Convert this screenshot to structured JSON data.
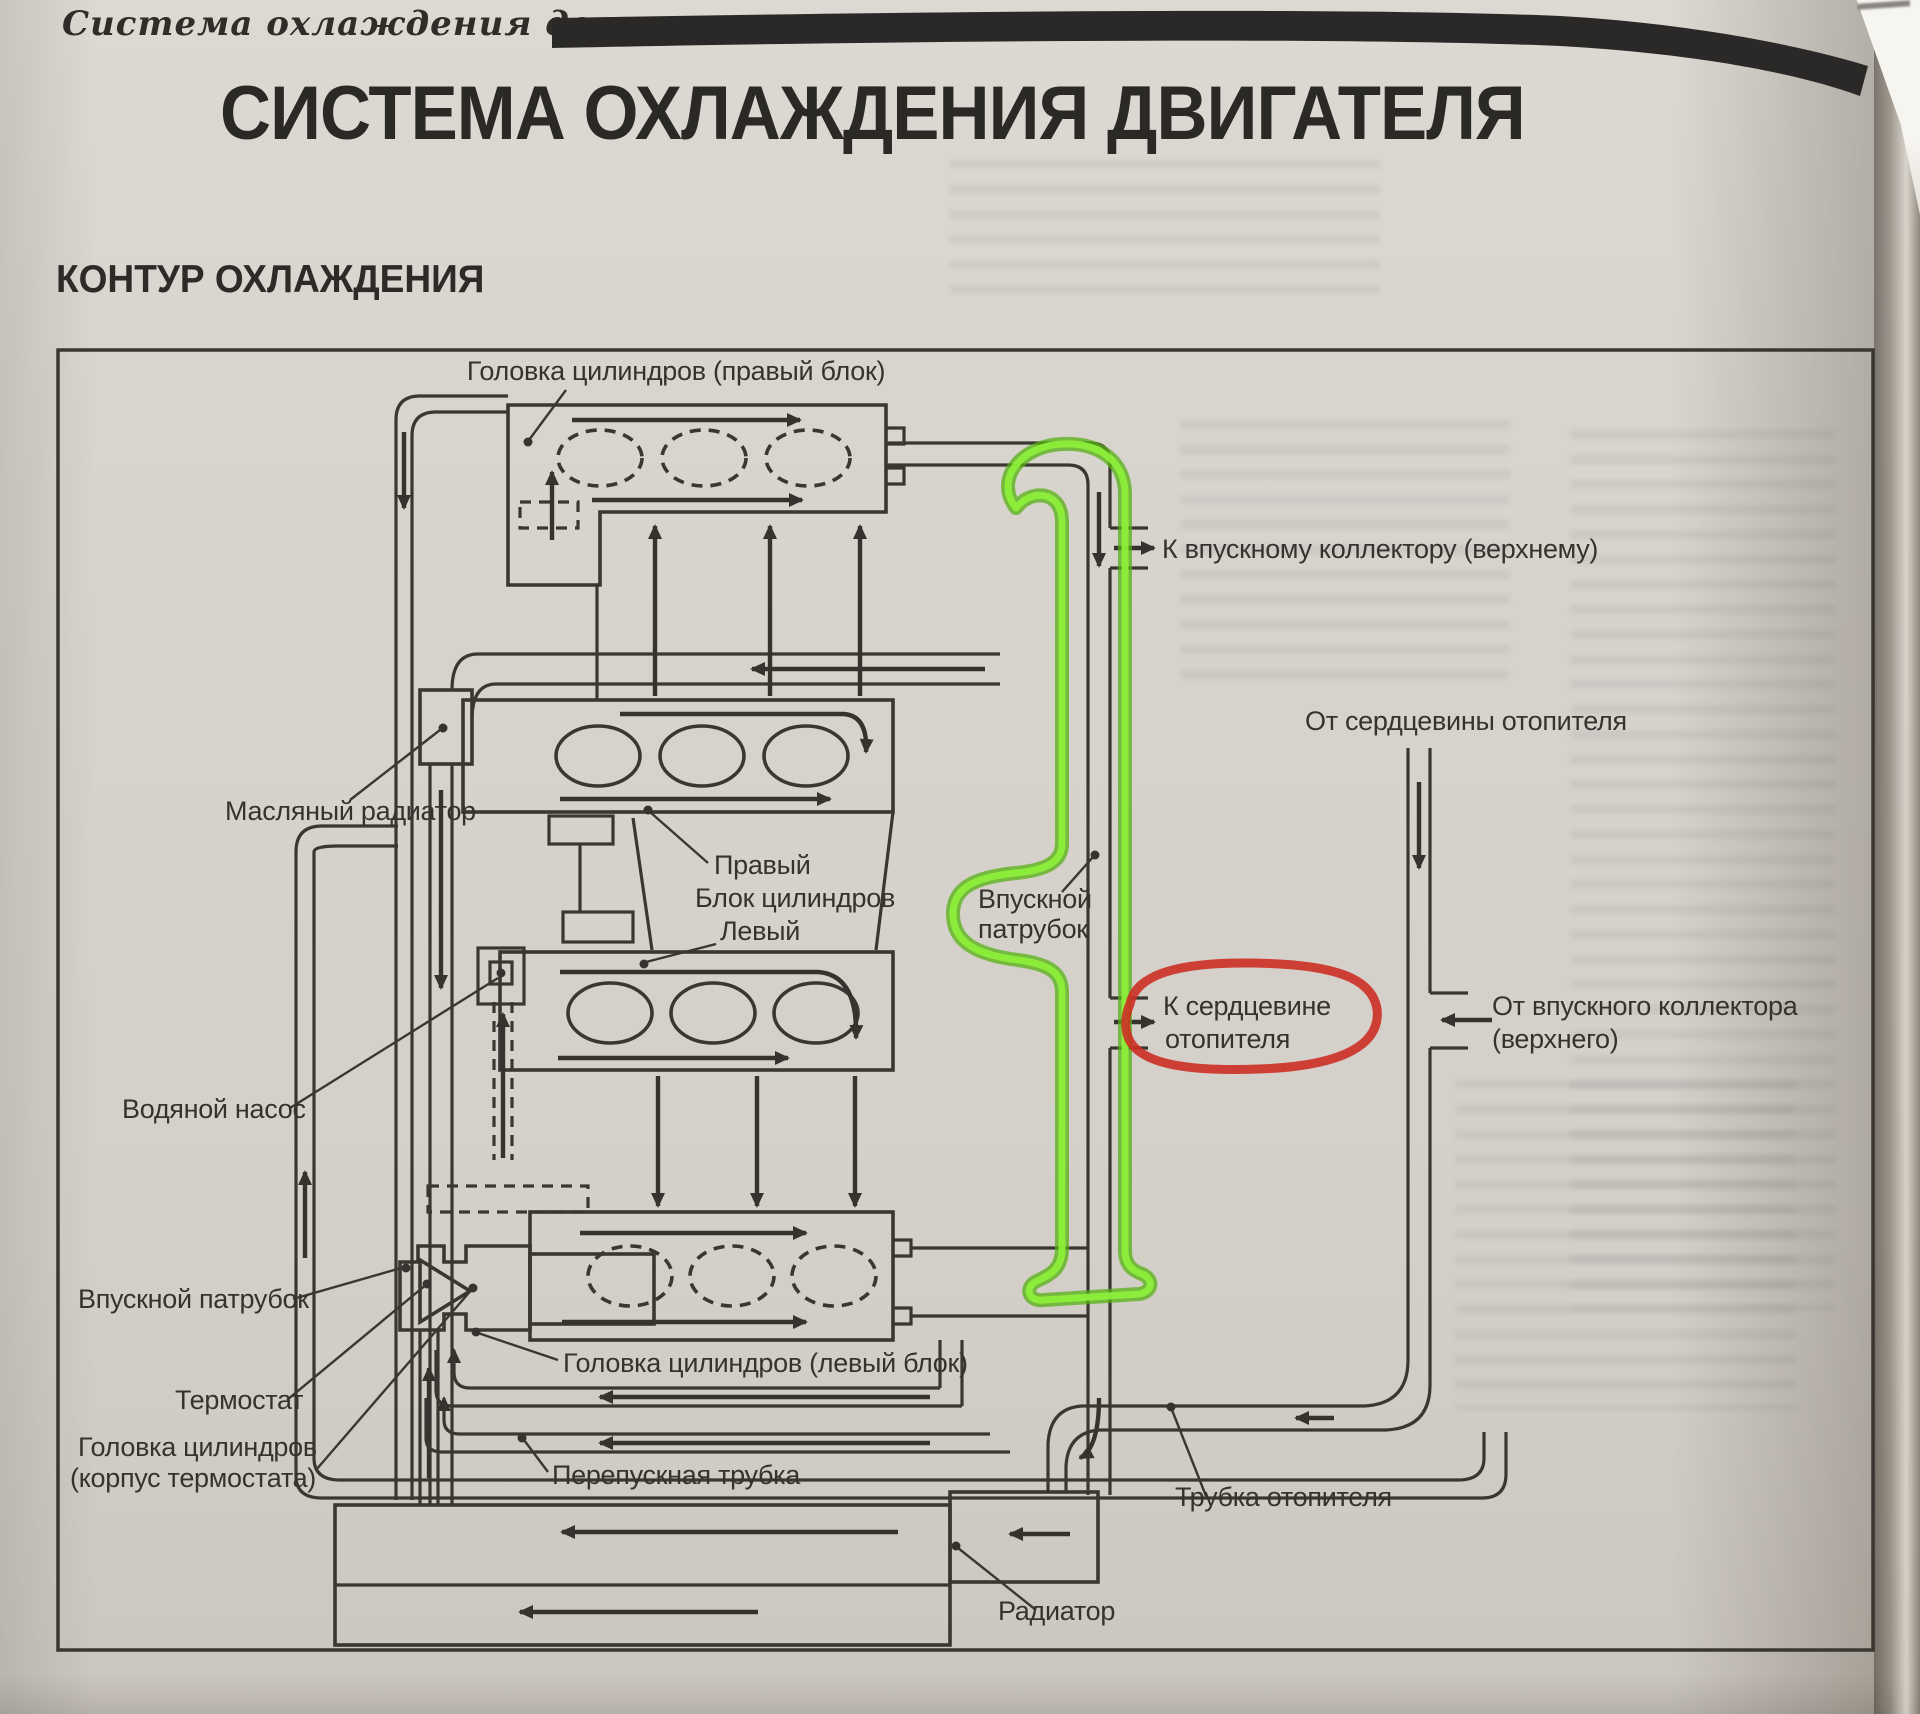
{
  "page": {
    "running_header": "Система охлаждения двигателя",
    "title": "СИСТЕМА ОХЛАЖДЕНИЯ ДВИГАТЕЛЯ",
    "section_heading": "КОНТУР ОХЛАЖДЕНИЯ"
  },
  "diagram": {
    "ink_color": "#3a3733",
    "labels": {
      "head_right": "Головка цилиндров (правый блок)",
      "to_intake_manifold": "К впускному коллектору (верхнему)",
      "oil_radiator": "Масляный радиатор",
      "bank_right": "Правый",
      "cylinder_block": "Блок цилиндров",
      "bank_left": "Левый",
      "intake_pipe_center": [
        "Впускной",
        "патрубок"
      ],
      "from_heater_core": "От сердцевины отопителя",
      "to_heater_core": [
        "К сердцевине",
        "отопителя"
      ],
      "from_intake_manifold": [
        "От впускного коллектора",
        "(верхнего)"
      ],
      "water_pump": "Водяной насос",
      "intake_pipe_left": "Впускной патрубок",
      "thermostat": "Термостат",
      "head_thermostat_housing": [
        "Головка цилиндров",
        "(корпус термостата)"
      ],
      "head_left": "Головка цилиндров (левый блок)",
      "bypass_pipe": "Перепускная трубка",
      "heater_pipe": "Трубка отопителя",
      "radiator": "Радиатор"
    },
    "annotations": {
      "highlighter": "green",
      "highlight_color": "#7edb30",
      "marker": "red",
      "marker_color": "#cc2f23"
    }
  }
}
